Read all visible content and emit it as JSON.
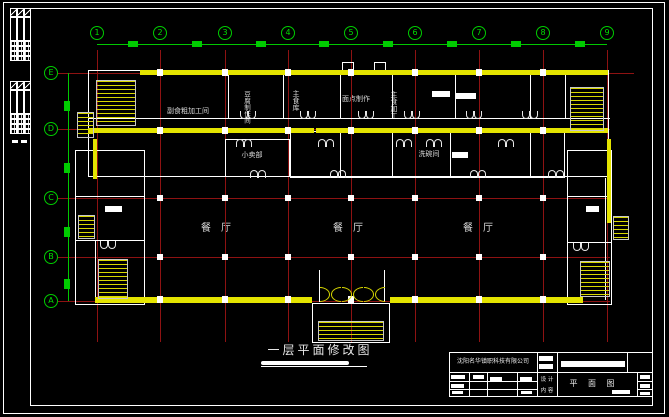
{
  "colors": {
    "background": "#000000",
    "frame_white": "#ffffff",
    "axis_green": "#00cc00",
    "grid_red": "#8e1212",
    "wall_yellow": "#e4e400",
    "label_white": "#d9d9d9"
  },
  "axes": {
    "top": [
      "1",
      "2",
      "3",
      "4",
      "5",
      "6",
      "7",
      "8",
      "9"
    ],
    "left": [
      "E",
      "D",
      "C",
      "B",
      "A"
    ]
  },
  "rooms": {
    "fushi_processing": "副食粗加工间",
    "doufu_room": "豆腐制作间",
    "staple_storage": "主食库",
    "pastry_making": "面点制作",
    "staple_processing": "主食加工",
    "dishwashing": "洗碗间",
    "kiosk": "小卖部",
    "dining_hall": "餐厅"
  },
  "title": {
    "plan_title": "一层平面修改图"
  },
  "title_block": {
    "company": "沈阳名华镇职科技有限公司",
    "drawing_name": "平 面 图",
    "label_design": "设 计",
    "label_content": "内 容"
  }
}
